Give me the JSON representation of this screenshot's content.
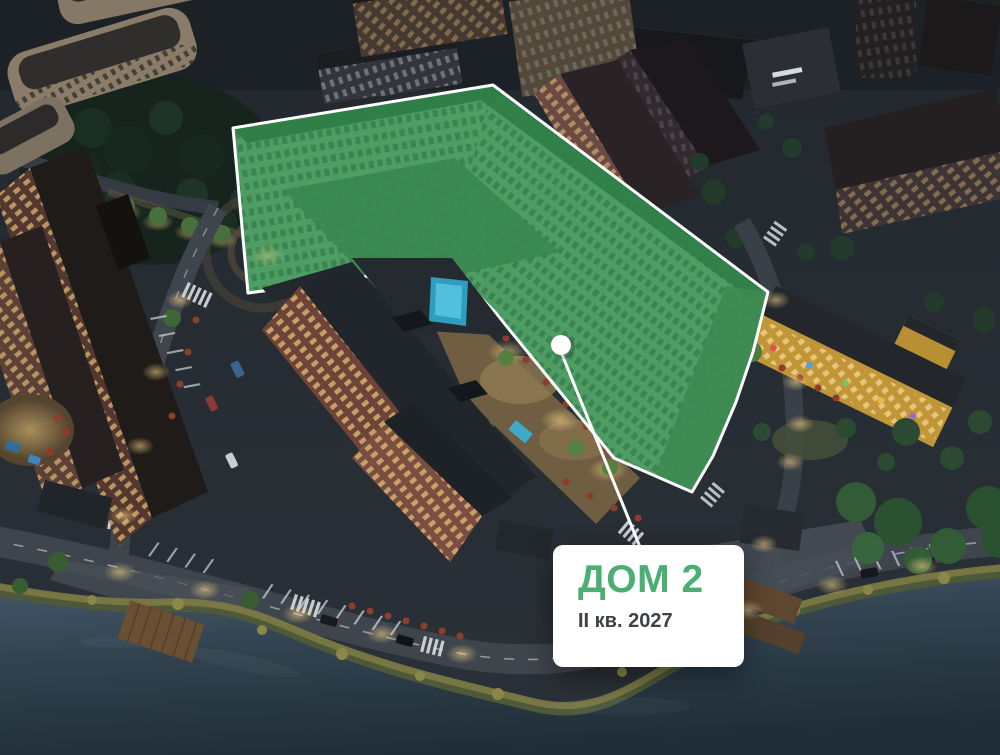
{
  "card": {
    "title": "ДОМ 2",
    "subtitle": "II кв. 2027",
    "title_color": "#4BAE73",
    "subtitle_color": "#3C4248",
    "background_color": "#FFFFFF"
  },
  "highlight": {
    "building_label": "ДОМ 2",
    "fill_color": "#4E9D63",
    "outline_color": "#FFFFFF",
    "marker_color": "#FFFFFF",
    "line_color": "#FFFFFF"
  },
  "palette": {
    "water": "#31424E",
    "ground": "#262D34",
    "warm_windows": "#E8C078",
    "brick_building": "#6E4438",
    "school_yellow": "#C09638",
    "accent_green": "#4BAE73"
  }
}
